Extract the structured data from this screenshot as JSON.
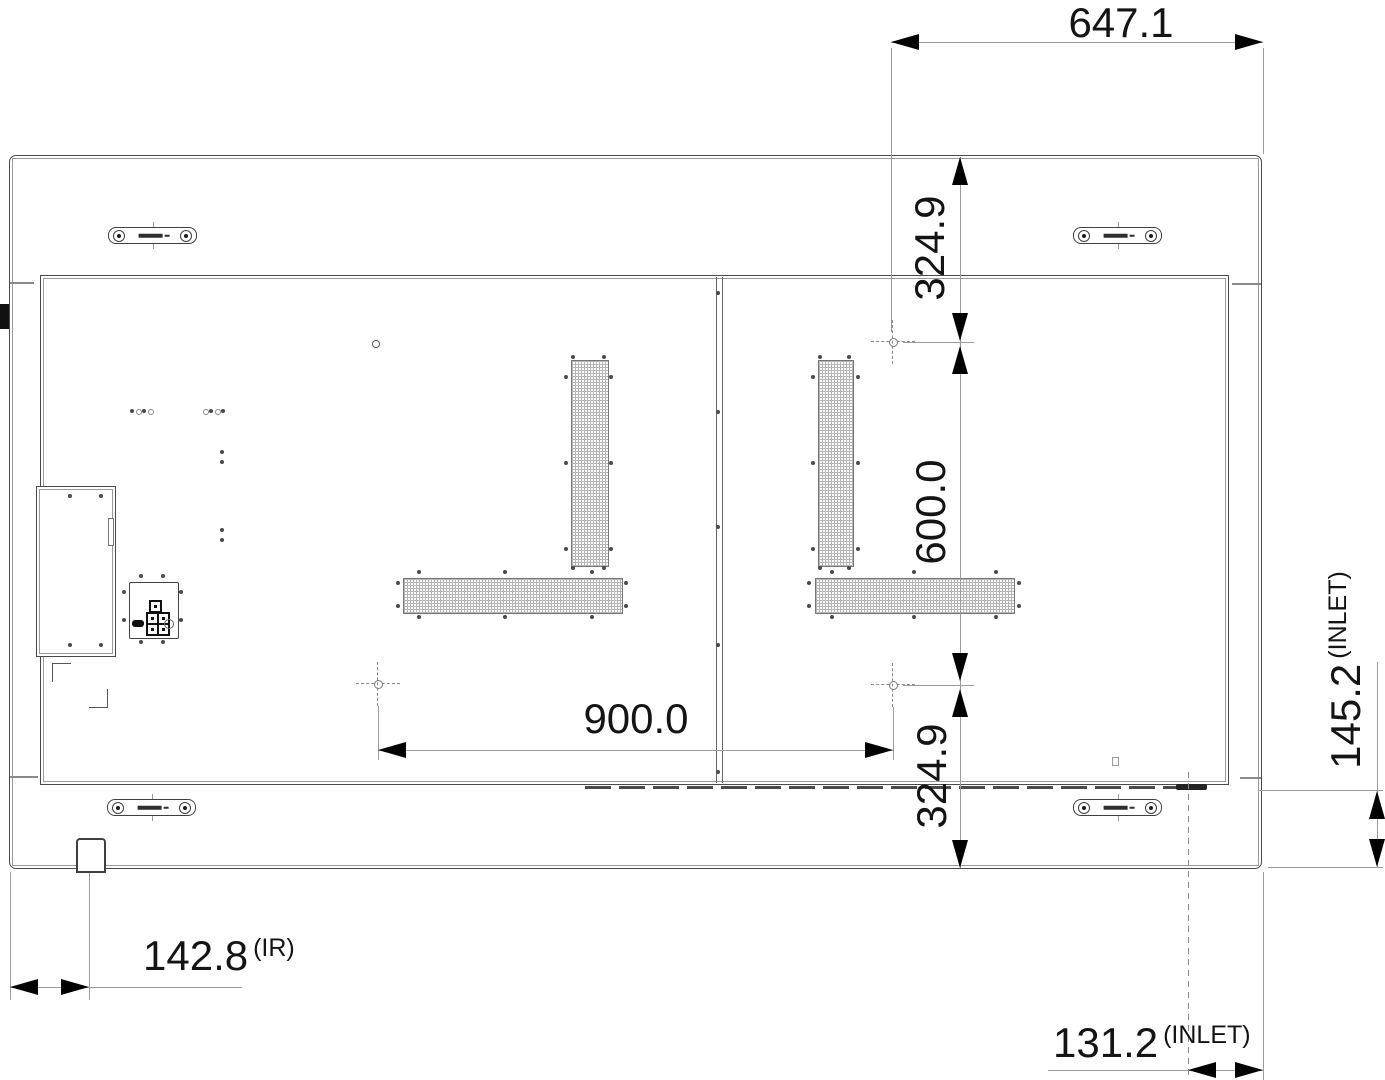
{
  "drawing": {
    "type": "display rear-view engineering drawing",
    "units_implied": "mm"
  },
  "dims": {
    "top_width": "647.1",
    "right_upper": "324.9",
    "right_middle": "600.0",
    "right_lower": "324.9",
    "center_width": "900.0",
    "ir_offset": "142.8",
    "ir_suffix": "(IR)",
    "inlet_bottom": "131.2",
    "inlet_bottom_suffix": "(INLET)",
    "inlet_right": "145.2",
    "inlet_right_suffix": "(INLET)"
  },
  "colors": {
    "line_dark": "#4a4a4a",
    "line_light": "#9b9b9b",
    "arrow": "#000000",
    "text": "#141414",
    "background": "#ffffff"
  }
}
